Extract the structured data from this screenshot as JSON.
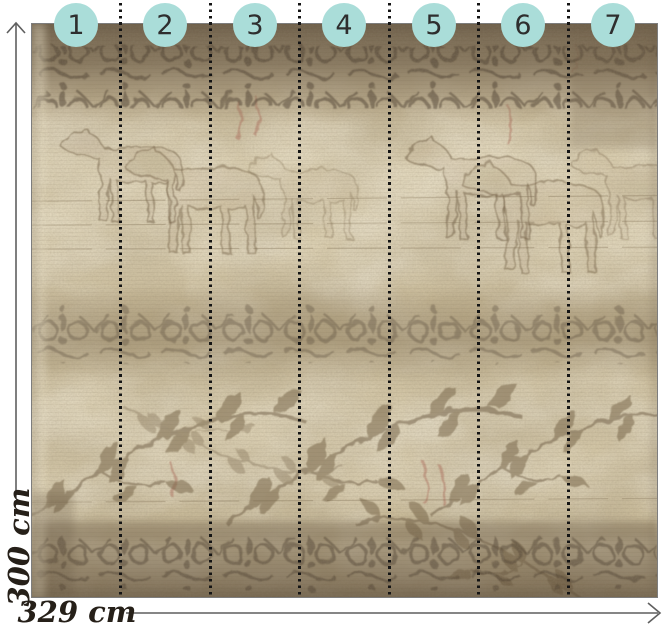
{
  "diagram": {
    "panels": [
      {
        "number": "1"
      },
      {
        "number": "2"
      },
      {
        "number": "3"
      },
      {
        "number": "4"
      },
      {
        "number": "5"
      },
      {
        "number": "6"
      },
      {
        "number": "7"
      }
    ],
    "dimensions": {
      "height_label": "300 cm",
      "width_label": "329 cm"
    },
    "icons": {
      "height_arrow": "chevron-up-icon",
      "width_arrow": "chevron-right-icon"
    },
    "colors": {
      "badge_fill": "#aaddd9",
      "badge_text": "#2e2e2e",
      "separator_dots": "#141414",
      "dimension_line": "#5f5f5f",
      "dimension_text": "#262019",
      "mural_border": "#7d7d7d",
      "mural_base": "#cdbf9e",
      "page_background": "#ffffff"
    }
  }
}
